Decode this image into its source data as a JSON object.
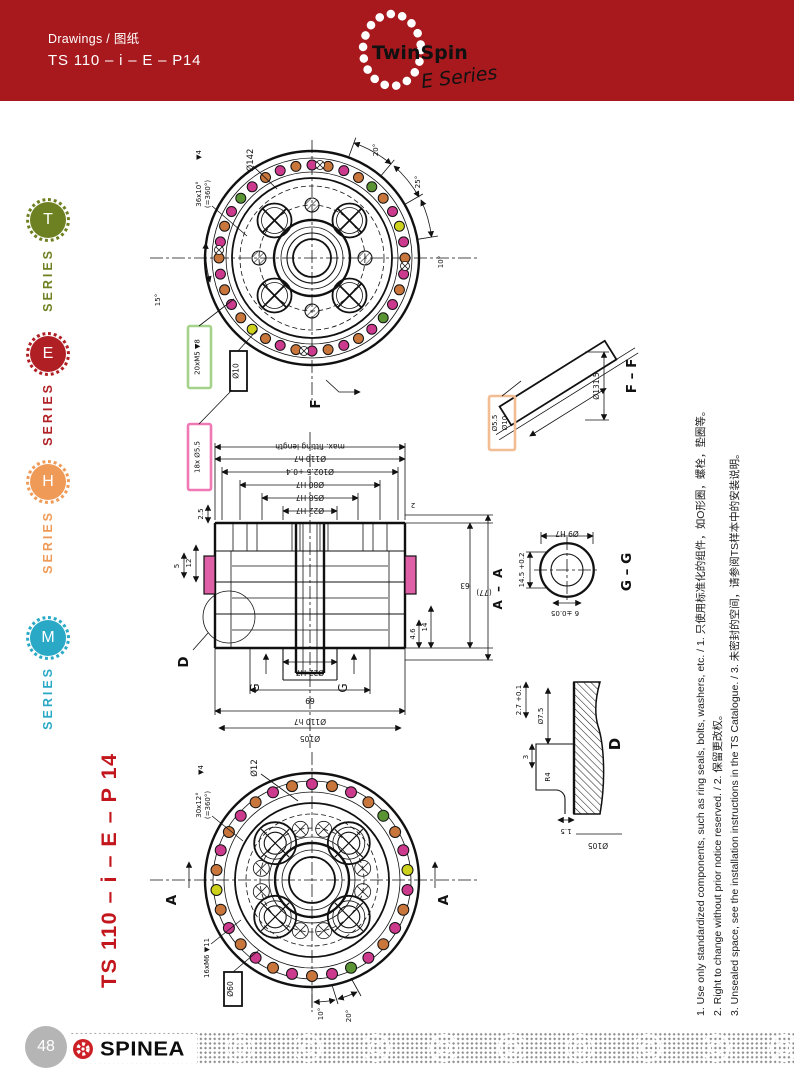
{
  "header": {
    "breadcrumb": "Drawings / 图纸",
    "model": "TS 110 – i – E – P14",
    "logo_brand": "TwinSpin",
    "logo_series": "E Series",
    "bg_color": "#a8191e"
  },
  "sidebar": {
    "series_word": "SERIES",
    "items": [
      {
        "letter": "T",
        "color": "#6e8122"
      },
      {
        "letter": "E",
        "color": "#b01f24"
      },
      {
        "letter": "H",
        "color": "#f09a57"
      },
      {
        "letter": "M",
        "color": "#2aa9c6"
      }
    ]
  },
  "vertical_title": "TS 110 – i – E – P 14",
  "drawings": {
    "top_view": {
      "dia": "Ø142",
      "pattern1": "36x10°",
      "pattern2": "(=360°)",
      "depth": "▼4",
      "ang1": "20°",
      "ang2": "25°",
      "ang3": "10°",
      "ang4": "15°",
      "box_green": "20xM5 ▼8",
      "box_black": "Ø10",
      "box_pink": "18x Ø5.5",
      "section_letter": "F"
    },
    "section_view": {
      "dim_fitting": "max. fitting length",
      "dim1": "Ø110 h7",
      "dim2": "Ø102.5 +0.4",
      "dim3": "Ø80 H7",
      "dim4": "Ø58 H7",
      "dim5": "Ø22 H7",
      "dim_chamfer": "2",
      "left1": "2.5",
      "left2": "12",
      "left3": "5",
      "right_63": "63",
      "right_77": "(77)",
      "right_14": "14",
      "right_46": "4.6",
      "bottom1": "Ø22 H7",
      "bottom2": "69",
      "bottom3": "Ø110 h7",
      "bottom4": "Ø105",
      "detail_letter": "D",
      "g_letter": "G",
      "section_label": "A – A"
    },
    "bottom_view": {
      "dia": "Ø12",
      "depth": "▼4",
      "pattern1": "30x12°",
      "pattern2": "(=360°)",
      "thread": "16xM6 ▼11",
      "box_black": "Ø60",
      "ang1": "10°",
      "ang2": "20°",
      "section_letter": "A"
    },
    "detail_ff": {
      "title": "F – F",
      "dim1": "Ø5.5",
      "dim2": "Ø10",
      "dim3": "Ø131.5"
    },
    "detail_gg": {
      "title": "G – G",
      "dim_top": "Ø9 H7",
      "dim_left": "14.5 +0.2",
      "dim_bottom": "6 ±0.05"
    },
    "detail_d": {
      "title": "D",
      "dim1": "Ø7.5",
      "dim2": "2.7 +0.1",
      "dim3": "3",
      "dim4": "R4",
      "dim5": "1.5",
      "dim6": "Ø105"
    },
    "dot_colors": {
      "magenta": "#cc3a8e",
      "orange": "#c8763c",
      "green": "#5a9334",
      "yellow": "#cdd11c"
    },
    "highlight_colors": {
      "green_box": "#a6d38b",
      "pink_box": "#f078b4",
      "orange_box": "#f2bd93"
    }
  },
  "notes": [
    "1. Use only standardized components, such as ring seals, bolts, washers, etc. / 1. 只使用标准化的组件，如O形圈，螺栓，垫圈等。",
    "2. Right to change without prior notice reserved. / 2. 保留更改权。",
    "3. Unsealed space, see the installation instructions in the TS Catalogue. / 3. 未密封的空间，请参阅TS样本中的安装说明。"
  ],
  "footer": {
    "page_number": "48",
    "brand": "SPINEA"
  }
}
